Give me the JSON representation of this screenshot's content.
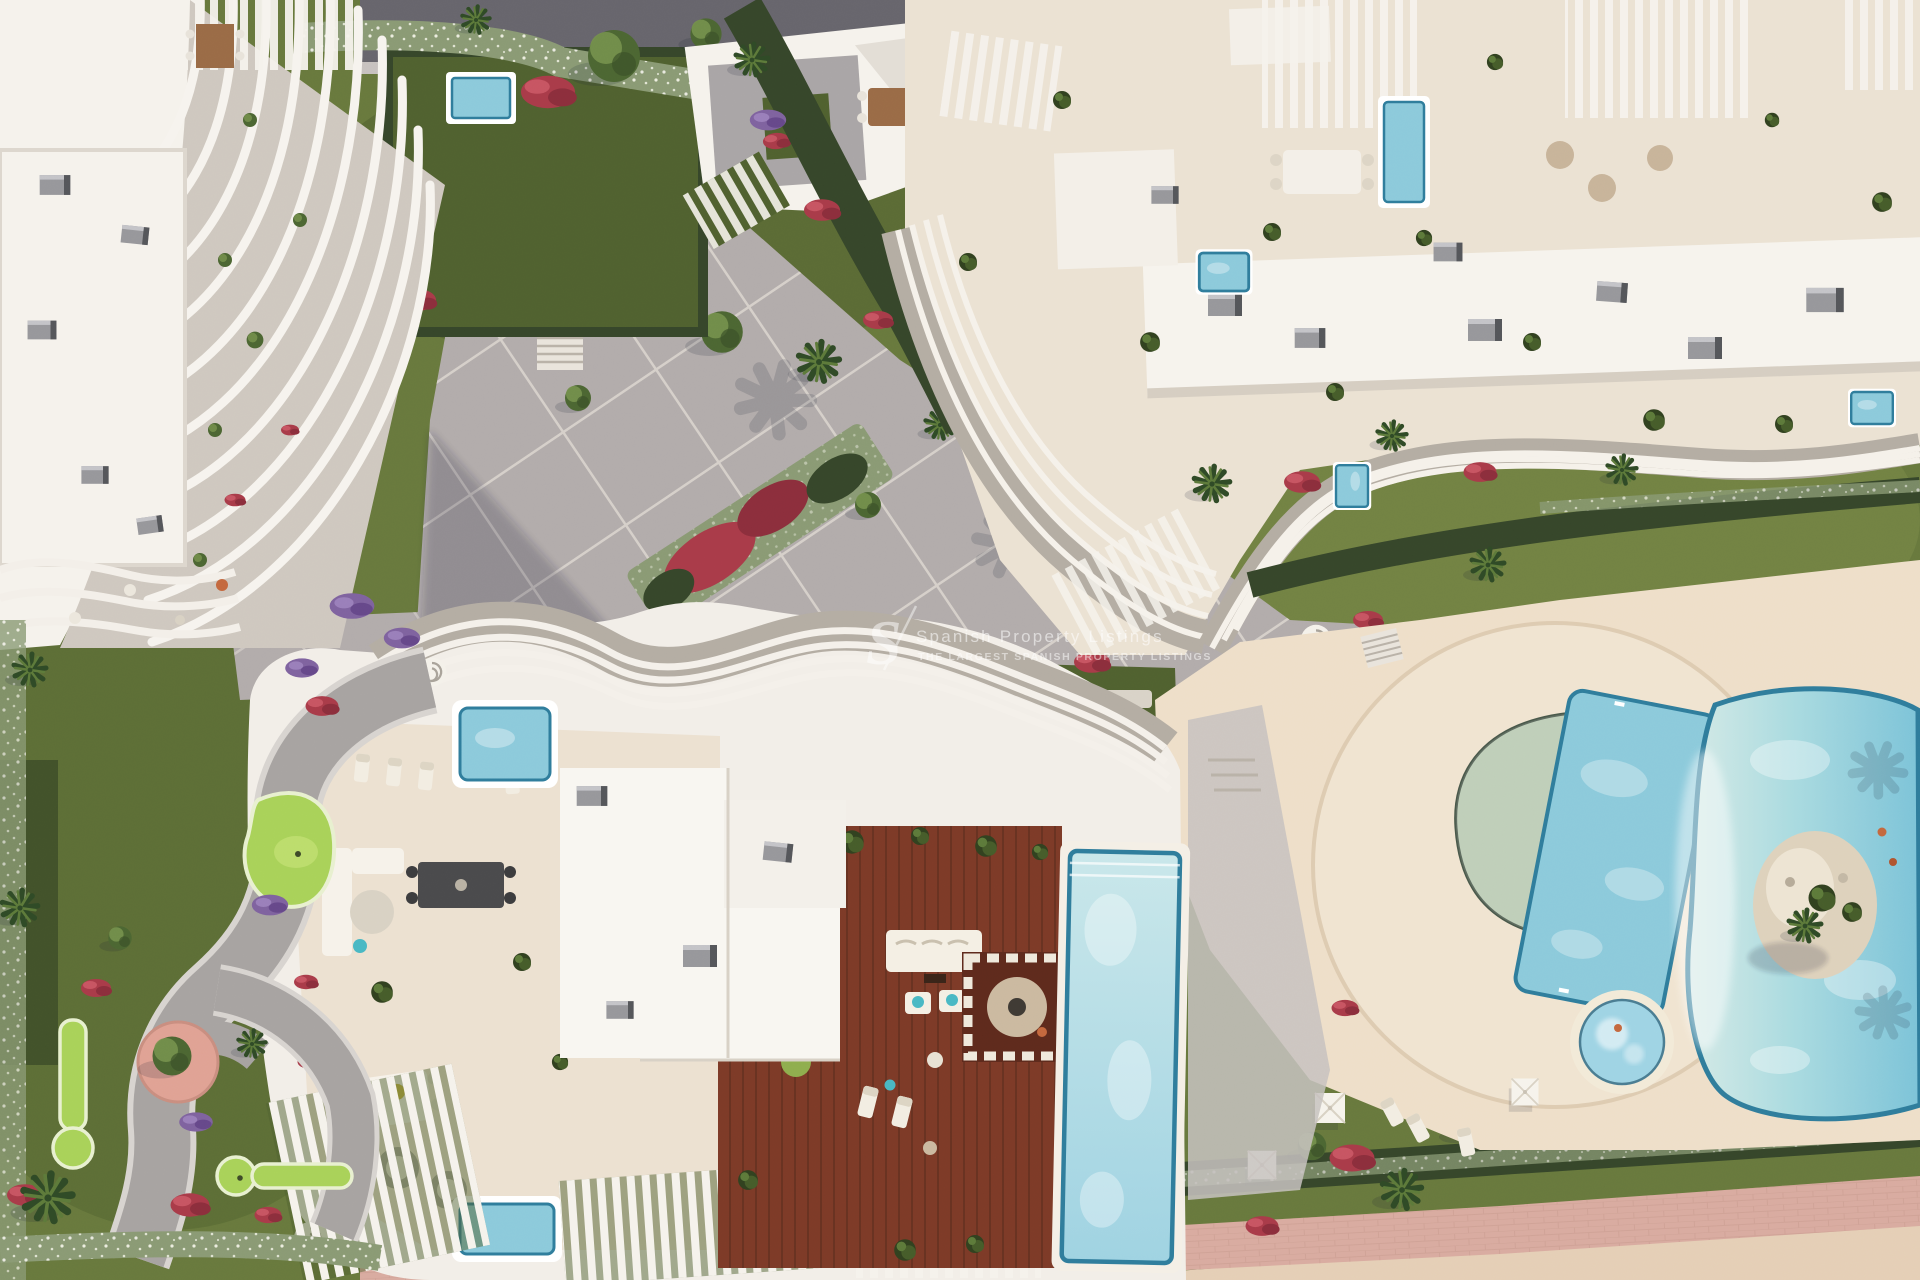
{
  "meta": {
    "type": "3d-architectural-aerial-render",
    "view": "top-down",
    "subject": "Modern white beachfront apartment complex with rooftop terraces, private plunge pools, timber penthouse deck with infinity pool, free-form lagoon pool, Mediterranean gardens, mini-golf greens and a pink beach promenade"
  },
  "watermark": {
    "logo_letter": "S",
    "title": "Spanish Property Listings",
    "subtitle": "THE LARGEST SPANISH PROPERTY LISTINGS"
  },
  "palette": {
    "grass": "#68793d",
    "grassLight": "#7b8c4a",
    "grassDark": "#50612f",
    "golf": "#a9d259",
    "golfLight": "#c0e070",
    "hedge": "#36462a",
    "hedgeLight": "#8a9a74",
    "flowerRed": "#a93b49",
    "flowerRedDark": "#8c2e3c",
    "flowerRedLight": "#c75562",
    "flowerPurple": "#7f629f",
    "paving": "#b2acab",
    "pavingLight": "#c7c2bf",
    "pavingLine": "#dcd6cf",
    "road": "#67656c",
    "white": "#f5f2ec",
    "cream": "#ebe2d3",
    "terrace": "#ece1d1",
    "deckCream": "#eedfc9",
    "shade": "#b4ada3",
    "grayBox": "#97979b",
    "grayDark": "#55565a",
    "wood": "#7d3a27",
    "woodDark": "#5e2a1c",
    "plankLine": "#63301f",
    "poolBlue": "#8ccadb",
    "poolPale": "#bfe2e3",
    "poolDeep": "#6cb8d0",
    "poolRim": "#2f7d9c",
    "poolSage": "#b7c9b0",
    "sand": "#e5cfb6",
    "islandSand": "#ded2bc",
    "promenade": "#d9aba0",
    "promLine": "#c89a8e",
    "palmDark": "#2f4a26",
    "palmLight": "#5d7a3a",
    "treeGreen": "#4c6632",
    "treeLight": "#76914c",
    "shadow": "rgba(28,33,55,0.28)",
    "watermark": "#ffffff"
  },
  "regions": {
    "top_left_building": "white apartment building with curved louvre fins and roof terraces",
    "central_plaza": "diagonal paved plaza with white grid joints, olive trees and flower beds",
    "top_right_building": "large apartment block with rooftop terraces, plunge pools and wavy balcony edge",
    "bottom_building": "penthouse roof with timber deck, infinity pool and louvred pergolas",
    "lagoon_pool": "free-form communal lagoon pool with planted island",
    "lap_pool": "rectangular communal lap pool",
    "half_moon_pool": "semi-circular shallow leisure pool",
    "jacuzzi": "round whirlpool spa",
    "mini_golf": "mini-golf putting greens",
    "beach_promenade": "pink paved promenade with flowering hedge and sand",
    "gardens": "gardens with palms, red and purple flower beds"
  }
}
